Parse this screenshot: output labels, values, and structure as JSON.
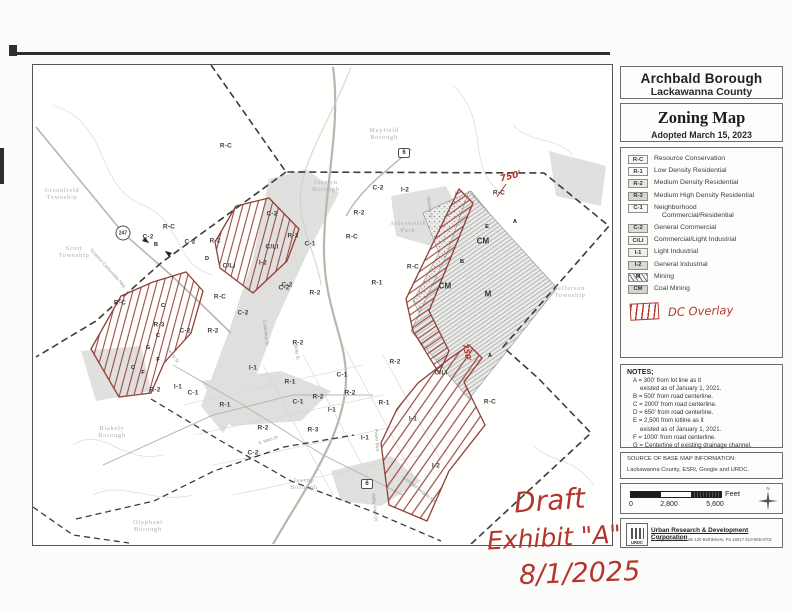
{
  "panel": {
    "title_box": {
      "line1": "Archbald Borough",
      "line2": "Lackawanna County"
    },
    "zoning": {
      "title": "Zoning Map",
      "subtitle": "Adopted March 15, 2023"
    }
  },
  "legend": {
    "items": [
      {
        "code": "R-C",
        "label": "Resource Conservation",
        "swatch": "#f6f6f4"
      },
      {
        "code": "R-1",
        "label": "Low Density Residential",
        "swatch": "#fbfbf9"
      },
      {
        "code": "R-2",
        "label": "Medium Density Residential",
        "swatch": "#e7e7e4"
      },
      {
        "code": "R-3",
        "label": "Medium High Density Residential",
        "swatch": "#d7d7d4"
      },
      {
        "code": "C-1",
        "label": "Neighborhood",
        "label2": "Commercial/Residential",
        "swatch": "#f8f8f6"
      },
      {
        "code": "C-2",
        "label": "General Commercial",
        "swatch": "#dbdbd8"
      },
      {
        "code": "C/LI",
        "label": "Commercial/Light Industrial",
        "swatch": "#f3f3f0"
      },
      {
        "code": "I-1",
        "label": "Light Industrial",
        "swatch": "#efefec"
      },
      {
        "code": "I-2",
        "label": "General Industrial",
        "swatch": "#d9d9d6"
      },
      {
        "code": "M",
        "label": "Mining",
        "swatch": "hatch"
      },
      {
        "code": "CM",
        "label": "Coal Mining",
        "swatch": "#d4d4d1"
      }
    ],
    "dc_overlay_label": "DC Overlay"
  },
  "notes": {
    "heading": "NOTES;",
    "lines": [
      {
        "text": "A = 300' from lot line as it",
        "indent": false
      },
      {
        "text": "existed as of January 1, 2021.",
        "indent": true
      },
      {
        "text": "B = 500' from road centerline.",
        "indent": false
      },
      {
        "text": "C = 2000' from road centerline.",
        "indent": false
      },
      {
        "text": "D = 650' from road centerline.",
        "indent": false
      },
      {
        "text": "E = 2,500 from lotline as it",
        "indent": false
      },
      {
        "text": "existed as of January 1, 2021.",
        "indent": true
      },
      {
        "text": "F = 1000' from road centerline.",
        "indent": false
      },
      {
        "text": "G = Centerline of existing drainage channel.",
        "indent": false
      }
    ]
  },
  "source": {
    "heading": "SOURCE OF BASE MAP INFORMATION:",
    "text": "Lackawanna County, ESRI, Google and URDC."
  },
  "scale": {
    "ticks": [
      "0",
      "2,800",
      "5,600"
    ],
    "tick_x": [
      630,
      668,
      714
    ],
    "unit": "Feet",
    "north": "N"
  },
  "credit": {
    "logo": "URDC",
    "org": "Urban Research & Development Corporation",
    "address": "51 Highland Ave Suite 120   Bethlehem, Pa 18017   610-865-0701"
  },
  "annotations": {
    "draft": "Draft",
    "exhibit": "Exhibit \"A\"",
    "date": "8/1/2025",
    "dim1": "750'",
    "dim2": "750'"
  },
  "map": {
    "zone_labels": [
      {
        "t": "R-C",
        "x": 226,
        "y": 146
      },
      {
        "t": "R-C",
        "x": 169,
        "y": 227
      },
      {
        "t": "C-2",
        "x": 148,
        "y": 237
      },
      {
        "t": "C-2",
        "x": 190,
        "y": 242
      },
      {
        "t": "R-2",
        "x": 215,
        "y": 241
      },
      {
        "t": "C-2",
        "x": 272,
        "y": 214
      },
      {
        "t": "C/LI",
        "x": 272,
        "y": 247
      },
      {
        "t": "R-3",
        "x": 293,
        "y": 236
      },
      {
        "t": "C/LI",
        "x": 229,
        "y": 266
      },
      {
        "t": "I-2",
        "x": 263,
        "y": 263
      },
      {
        "t": "C-2",
        "x": 284,
        "y": 288
      },
      {
        "t": "R-C",
        "x": 220,
        "y": 297
      },
      {
        "t": "C-2",
        "x": 243,
        "y": 313
      },
      {
        "t": "R-C",
        "x": 120,
        "y": 303
      },
      {
        "t": "R-3",
        "x": 159,
        "y": 325
      },
      {
        "t": "C-2",
        "x": 185,
        "y": 331
      },
      {
        "t": "R-2",
        "x": 213,
        "y": 331
      },
      {
        "t": "C-1",
        "x": 310,
        "y": 244
      },
      {
        "t": "R-2",
        "x": 359,
        "y": 213
      },
      {
        "t": "C-2",
        "x": 378,
        "y": 188
      },
      {
        "t": "I-2",
        "x": 405,
        "y": 190
      },
      {
        "t": "R-C",
        "x": 352,
        "y": 237
      },
      {
        "t": "R-C",
        "x": 413,
        "y": 267
      },
      {
        "t": "R-1",
        "x": 377,
        "y": 283
      },
      {
        "t": "C-2",
        "x": 287,
        "y": 285
      },
      {
        "t": "R-2",
        "x": 315,
        "y": 293
      },
      {
        "t": "R-C",
        "x": 499,
        "y": 193
      },
      {
        "t": "CM",
        "x": 483,
        "y": 241,
        "big": true
      },
      {
        "t": "CM",
        "x": 445,
        "y": 286,
        "big": true
      },
      {
        "t": "M",
        "x": 488,
        "y": 294,
        "big": true
      },
      {
        "t": "R-2",
        "x": 155,
        "y": 390
      },
      {
        "t": "I-1",
        "x": 178,
        "y": 387
      },
      {
        "t": "C-1",
        "x": 193,
        "y": 393
      },
      {
        "t": "R-2",
        "x": 298,
        "y": 343
      },
      {
        "t": "I-1",
        "x": 253,
        "y": 368
      },
      {
        "t": "R-1",
        "x": 290,
        "y": 382
      },
      {
        "t": "C-1",
        "x": 342,
        "y": 375
      },
      {
        "t": "R-1",
        "x": 225,
        "y": 405
      },
      {
        "t": "C-1",
        "x": 298,
        "y": 402
      },
      {
        "t": "R-2",
        "x": 318,
        "y": 397
      },
      {
        "t": "R-2",
        "x": 350,
        "y": 393
      },
      {
        "t": "I-1",
        "x": 332,
        "y": 410
      },
      {
        "t": "R-2",
        "x": 263,
        "y": 428
      },
      {
        "t": "R-3",
        "x": 313,
        "y": 430
      },
      {
        "t": "C-2",
        "x": 253,
        "y": 453
      },
      {
        "t": "I-1",
        "x": 365,
        "y": 438
      },
      {
        "t": "R-2",
        "x": 395,
        "y": 362
      },
      {
        "t": "C/LI",
        "x": 441,
        "y": 373
      },
      {
        "t": "R-1",
        "x": 384,
        "y": 403
      },
      {
        "t": "I-1",
        "x": 413,
        "y": 419
      },
      {
        "t": "R-C",
        "x": 490,
        "y": 402
      },
      {
        "t": "I-2",
        "x": 436,
        "y": 466
      }
    ],
    "markers": [
      {
        "t": "B",
        "x": 156,
        "y": 245
      },
      {
        "t": "D",
        "x": 207,
        "y": 259
      },
      {
        "t": "C",
        "x": 163,
        "y": 306
      },
      {
        "t": "C",
        "x": 158,
        "y": 336
      },
      {
        "t": "G",
        "x": 148,
        "y": 348
      },
      {
        "t": "F",
        "x": 158,
        "y": 360
      },
      {
        "t": "C",
        "x": 133,
        "y": 368
      },
      {
        "t": "F",
        "x": 143,
        "y": 373
      },
      {
        "t": "E",
        "x": 487,
        "y": 227
      },
      {
        "t": "B",
        "x": 462,
        "y": 262
      },
      {
        "t": "A",
        "x": 515,
        "y": 222
      },
      {
        "t": "A",
        "x": 490,
        "y": 356
      }
    ],
    "place_labels": [
      {
        "lines": [
          "Greenfield",
          "Township"
        ],
        "x": 62,
        "y": 194
      },
      {
        "lines": [
          "Scott",
          "Township"
        ],
        "x": 74,
        "y": 252
      },
      {
        "lines": [
          "Mayfield",
          "Borough"
        ],
        "x": 384,
        "y": 134
      },
      {
        "lines": [
          "Jermyn",
          "Borough"
        ],
        "x": 326,
        "y": 186
      },
      {
        "lines": [
          "Aylesworth",
          "Park"
        ],
        "x": 408,
        "y": 227
      },
      {
        "lines": [
          "Jefferson",
          "Township"
        ],
        "x": 570,
        "y": 292
      },
      {
        "lines": [
          "Blakely",
          "Borough"
        ],
        "x": 112,
        "y": 432
      },
      {
        "lines": [
          "Olyphant",
          "Borough"
        ],
        "x": 148,
        "y": 526
      },
      {
        "lines": [
          "Jessup",
          "Borough"
        ],
        "x": 304,
        "y": 484
      }
    ],
    "street_labels": [
      {
        "t": "Hudson St",
        "x": 430,
        "y": 207,
        "r": 82
      },
      {
        "t": "Kenny St",
        "x": 173,
        "y": 355,
        "r": 55
      },
      {
        "t": "S. Main St",
        "x": 268,
        "y": 440,
        "r": -18
      },
      {
        "t": "Betty St",
        "x": 297,
        "y": 352,
        "r": 80
      },
      {
        "t": "Columbus Dr",
        "x": 266,
        "y": 333,
        "r": 84
      },
      {
        "t": "Valley View Dr",
        "x": 375,
        "y": 507,
        "r": 84
      },
      {
        "t": "Power Blvd",
        "x": 377,
        "y": 440,
        "r": 86
      },
      {
        "t": "Archbald Heights Rd",
        "x": 419,
        "y": 489,
        "r": 38
      },
      {
        "t": "Scranton Carbondale Hwy",
        "x": 108,
        "y": 268,
        "r": 48
      }
    ],
    "shields": [
      {
        "t": "247",
        "x": 123,
        "y": 233,
        "shape": "circle"
      },
      {
        "t": "6",
        "x": 404,
        "y": 153,
        "shape": "rect"
      },
      {
        "t": "6",
        "x": 367,
        "y": 484,
        "shape": "rect"
      }
    ]
  },
  "colors": {
    "overlay_red": "#9c4a42",
    "handwriting_red": "#b5352d",
    "boundary": "#3c3c3c",
    "zone_gray": "#c6c6c3"
  }
}
